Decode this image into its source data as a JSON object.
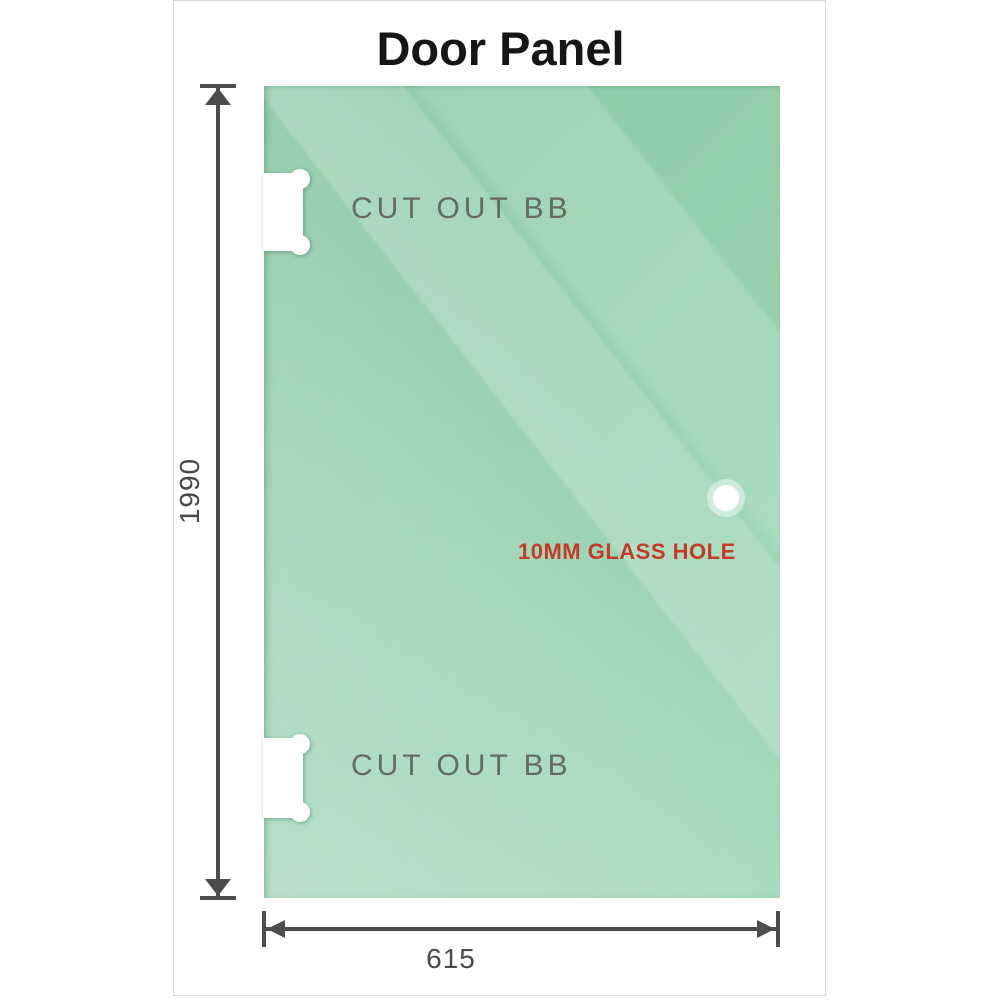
{
  "title": "Door Panel",
  "panel": {
    "cutout_top_label": "CUT OUT BB",
    "cutout_bottom_label": "CUT OUT BB",
    "hole_label": "10MM GLASS HOLE"
  },
  "dimensions": {
    "height_label": "1990",
    "width_label": "615"
  },
  "colors": {
    "glass_base": "#93ceac",
    "glass_highlight": "#bce3cc",
    "title_text": "#161616",
    "cutout_label_text": "#5c625c",
    "hole_label_text": "#c23b2b",
    "dimension_lines": "#4d4d4d",
    "sheet_border": "#d8d8d8",
    "background": "#ffffff"
  }
}
